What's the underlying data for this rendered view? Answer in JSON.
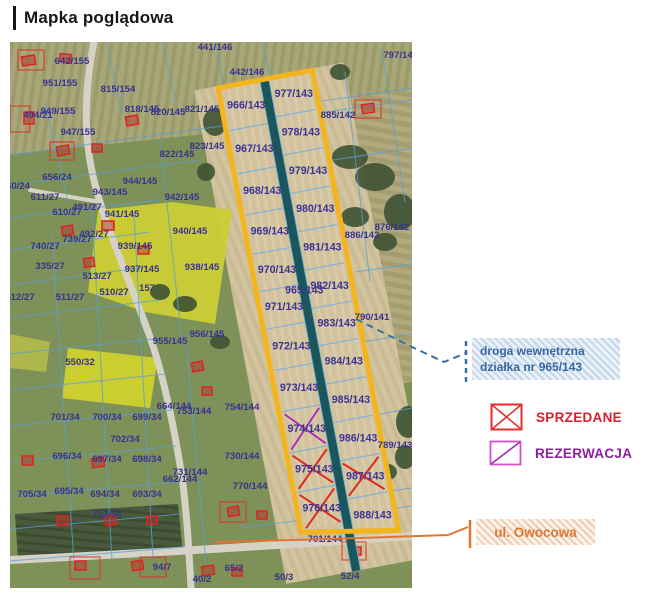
{
  "title": "Mapka poglądowa",
  "legend": {
    "road_note_line1": "droga wewnętrzna",
    "road_note_line2": "działka nr 965/143",
    "sold": "SPRZEDANE",
    "reserved": "REZERWACJA",
    "street": "ul. Owocowa"
  },
  "colors": {
    "outline": "#F3B51B",
    "internal_road": "#1A565C",
    "sold": "#E02A1E",
    "reserved": "#A826B4",
    "parcel_line": "#5B9FD4",
    "label": "#37338F",
    "note_blue": "#39689F",
    "street_orange": "#E0762F"
  },
  "strip": {
    "road_parcel": "965/143",
    "left_plots": [
      {
        "label": "966/143",
        "status": "available"
      },
      {
        "label": "967/143",
        "status": "available"
      },
      {
        "label": "968/143",
        "status": "available"
      },
      {
        "label": "969/143",
        "status": "available"
      },
      {
        "label": "970/143",
        "status": "available"
      },
      {
        "label": "971/143",
        "status": "available"
      },
      {
        "label": "972/143",
        "status": "available"
      },
      {
        "label": "973/143",
        "status": "available"
      },
      {
        "label": "974/143",
        "status": "reserved"
      },
      {
        "label": "975/143",
        "status": "sold"
      },
      {
        "label": "976/143",
        "status": "sold"
      }
    ],
    "right_plots": [
      {
        "label": "977/143",
        "status": "available"
      },
      {
        "label": "978/143",
        "status": "available"
      },
      {
        "label": "979/143",
        "status": "available"
      },
      {
        "label": "980/143",
        "status": "available"
      },
      {
        "label": "981/143",
        "status": "available"
      },
      {
        "label": "982/143",
        "status": "available"
      },
      {
        "label": "983/143",
        "status": "available"
      },
      {
        "label": "984/143",
        "status": "available"
      },
      {
        "label": "985/143",
        "status": "available"
      },
      {
        "label": "986/143",
        "status": "available"
      },
      {
        "label": "987/143",
        "status": "sold"
      },
      {
        "label": "988/143",
        "status": "available"
      }
    ]
  },
  "map_labels": [
    {
      "t": "441/146",
      "x": 205,
      "y": 8
    },
    {
      "t": "442/146",
      "x": 237,
      "y": 33
    },
    {
      "t": "797/14",
      "x": 388,
      "y": 16
    },
    {
      "t": "642/155",
      "x": 62,
      "y": 22
    },
    {
      "t": "951/155",
      "x": 50,
      "y": 44
    },
    {
      "t": "815/154",
      "x": 108,
      "y": 50
    },
    {
      "t": "885/142",
      "x": 328,
      "y": 76
    },
    {
      "t": "949/155",
      "x": 48,
      "y": 72
    },
    {
      "t": "494/21",
      "x": 28,
      "y": 76
    },
    {
      "t": "818/145",
      "x": 132,
      "y": 70
    },
    {
      "t": "820/145",
      "x": 158,
      "y": 73
    },
    {
      "t": "821/145",
      "x": 192,
      "y": 70
    },
    {
      "t": "947/155",
      "x": 68,
      "y": 93
    },
    {
      "t": "823/145",
      "x": 197,
      "y": 107
    },
    {
      "t": "822/145",
      "x": 167,
      "y": 115
    },
    {
      "t": "656/24",
      "x": 47,
      "y": 138
    },
    {
      "t": "60/24",
      "x": 8,
      "y": 147
    },
    {
      "t": "944/145",
      "x": 130,
      "y": 142
    },
    {
      "t": "943/145",
      "x": 100,
      "y": 153
    },
    {
      "t": "611/27",
      "x": 35,
      "y": 158
    },
    {
      "t": "942/145",
      "x": 172,
      "y": 158
    },
    {
      "t": "491/27",
      "x": 77,
      "y": 168
    },
    {
      "t": "610/27",
      "x": 57,
      "y": 173
    },
    {
      "t": "941/145",
      "x": 112,
      "y": 175
    },
    {
      "t": "940/145",
      "x": 180,
      "y": 192
    },
    {
      "t": "492/27",
      "x": 84,
      "y": 195
    },
    {
      "t": "739/27",
      "x": 67,
      "y": 200
    },
    {
      "t": "740/27",
      "x": 35,
      "y": 207
    },
    {
      "t": "939/145",
      "x": 125,
      "y": 207
    },
    {
      "t": "335/27",
      "x": 40,
      "y": 227
    },
    {
      "t": "937/145",
      "x": 132,
      "y": 230
    },
    {
      "t": "938/145",
      "x": 192,
      "y": 228
    },
    {
      "t": "513/27",
      "x": 87,
      "y": 237
    },
    {
      "t": "157",
      "x": 137,
      "y": 249
    },
    {
      "t": "510/27",
      "x": 104,
      "y": 253
    },
    {
      "t": "511/27",
      "x": 60,
      "y": 258
    },
    {
      "t": "512/27",
      "x": 10,
      "y": 258
    },
    {
      "t": "886/142",
      "x": 352,
      "y": 196
    },
    {
      "t": "876/142",
      "x": 382,
      "y": 188
    },
    {
      "t": "955/145",
      "x": 160,
      "y": 302
    },
    {
      "t": "956/145",
      "x": 197,
      "y": 295
    },
    {
      "t": "550/32",
      "x": 70,
      "y": 323
    },
    {
      "t": "790/141",
      "x": 362,
      "y": 278
    },
    {
      "t": "664/144",
      "x": 164,
      "y": 367
    },
    {
      "t": "753/144",
      "x": 184,
      "y": 372
    },
    {
      "t": "754/144",
      "x": 232,
      "y": 368
    },
    {
      "t": "701/34",
      "x": 55,
      "y": 378
    },
    {
      "t": "700/34",
      "x": 97,
      "y": 378
    },
    {
      "t": "699/34",
      "x": 137,
      "y": 378
    },
    {
      "t": "702/34",
      "x": 115,
      "y": 400
    },
    {
      "t": "730/144",
      "x": 232,
      "y": 417
    },
    {
      "t": "696/34",
      "x": 57,
      "y": 417
    },
    {
      "t": "697/34",
      "x": 97,
      "y": 420
    },
    {
      "t": "698/34",
      "x": 137,
      "y": 420
    },
    {
      "t": "731/144",
      "x": 180,
      "y": 433
    },
    {
      "t": "662/144",
      "x": 170,
      "y": 440
    },
    {
      "t": "770/144",
      "x": 240,
      "y": 447
    },
    {
      "t": "705/34",
      "x": 22,
      "y": 455
    },
    {
      "t": "695/34",
      "x": 59,
      "y": 452
    },
    {
      "t": "694/34",
      "x": 95,
      "y": 455
    },
    {
      "t": "693/34",
      "x": 137,
      "y": 455
    },
    {
      "t": "713/34",
      "x": 97,
      "y": 475
    },
    {
      "t": "789/143",
      "x": 385,
      "y": 406
    },
    {
      "t": "701/144",
      "x": 315,
      "y": 500
    },
    {
      "t": "94/7",
      "x": 152,
      "y": 528
    },
    {
      "t": "65/2",
      "x": 224,
      "y": 529
    },
    {
      "t": "40/2",
      "x": 192,
      "y": 540
    },
    {
      "t": "50/3",
      "x": 274,
      "y": 538
    },
    {
      "t": "52/4",
      "x": 340,
      "y": 537
    }
  ]
}
